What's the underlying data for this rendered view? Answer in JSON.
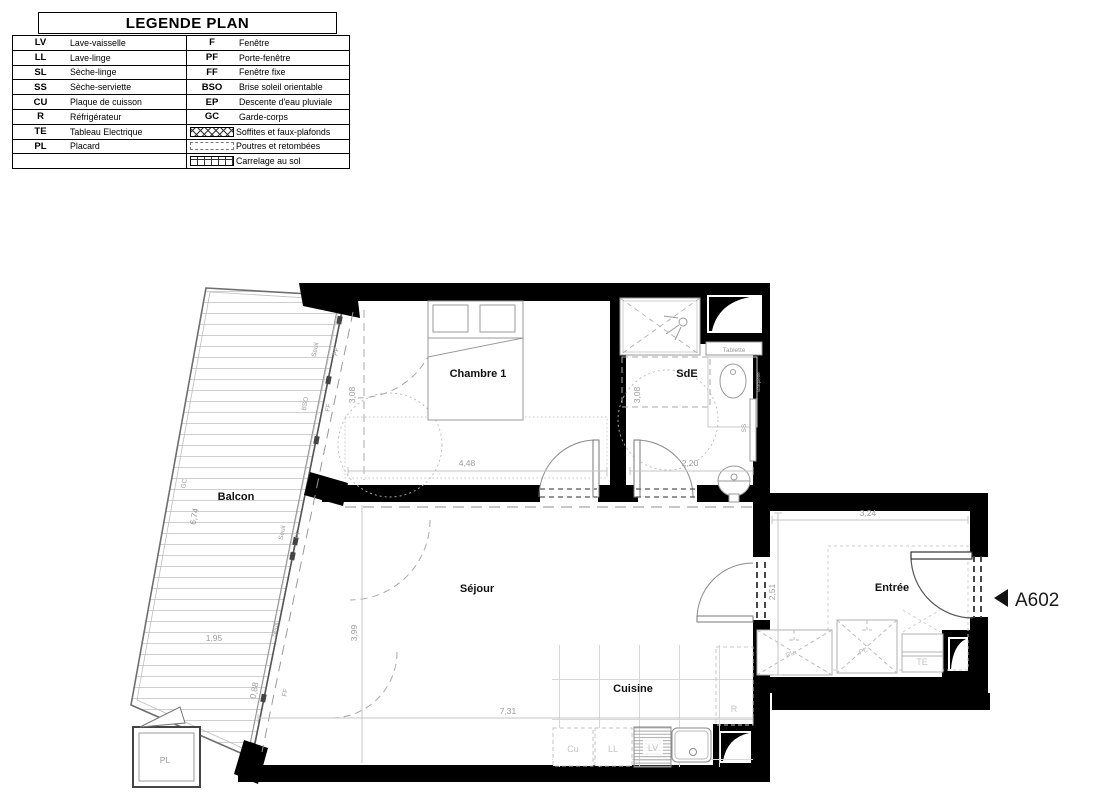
{
  "legend": {
    "title": "LEGENDE PLAN",
    "rows": [
      {
        "a1": "LV",
        "l1": "Lave-vaisselle",
        "a2": "F",
        "l2": "Fenêtre"
      },
      {
        "a1": "LL",
        "l1": "Lave-linge",
        "a2": "PF",
        "l2": "Porte-fenêtre"
      },
      {
        "a1": "SL",
        "l1": "Sèche-linge",
        "a2": "FF",
        "l2": "Fenêtre fixe"
      },
      {
        "a1": "SS",
        "l1": "Sèche-serviette",
        "a2": "BSO",
        "l2": "Brise soleil orientable"
      },
      {
        "a1": "CU",
        "l1": "Plaque de cuisson",
        "a2": "EP",
        "l2": "Descente d'eau pluviale"
      },
      {
        "a1": "R",
        "l1": "Réfrigérateur",
        "a2": "GC",
        "l2": "Garde-corps"
      },
      {
        "a1": "TE",
        "l1": "Tableau Electrique",
        "a2": "",
        "l2": "Soffites et faux-plafonds",
        "symbol": "hatch-x"
      },
      {
        "a1": "PL",
        "l1": "Placard",
        "a2": "",
        "l2": "Poutres et retombées",
        "symbol": "dashed"
      },
      {
        "a1": "",
        "l1": "",
        "a2": "",
        "l2": "Carrelage au sol",
        "symbol": "grid"
      }
    ]
  },
  "plan": {
    "unit": "A602",
    "rooms": {
      "chambre": "Chambre 1",
      "sde": "SdE",
      "sejour": "Séjour",
      "cuisine": "Cuisine",
      "entree": "Entrée",
      "balcon": "Balcon"
    },
    "dimensions": {
      "chambre_w": "4,48",
      "chambre_h": "3,08",
      "sde_w": "2,20",
      "sde_h": "3,08",
      "sejour_w": "7,31",
      "sejour_h": "3,99",
      "entree_w": "3,24",
      "entree_h": "2,51",
      "balcon_len": "6,74",
      "balcon_w": "1,95",
      "balcon_w2": "0,88"
    },
    "fixtures": {
      "tablette": "Tablette",
      "vasque_note": "Barquette",
      "seche_serviette": "SS",
      "cuisson": "Cu",
      "lave_linge": "LL",
      "lave_vaisselle": "LV",
      "refrigerateur": "R",
      "tableau_electrique": "TE",
      "placard_balcon": "PL",
      "placard_entree_1": "PL",
      "placard_entree_2": "PL",
      "garde_corps": "GC"
    },
    "facade": {
      "seuil_1": "Seuil",
      "pf_1": "PF",
      "bso": "BSO",
      "ff_1": "FF",
      "seuil_2": "Seuil",
      "pf_2": "PF",
      "seuil_3": "Seuil",
      "ff_2": "FF"
    }
  },
  "colors": {
    "wall": "#000000",
    "fixture_line": "#9a9a9a",
    "dim_text": "#9c9c9c",
    "label_text": "#111111"
  }
}
